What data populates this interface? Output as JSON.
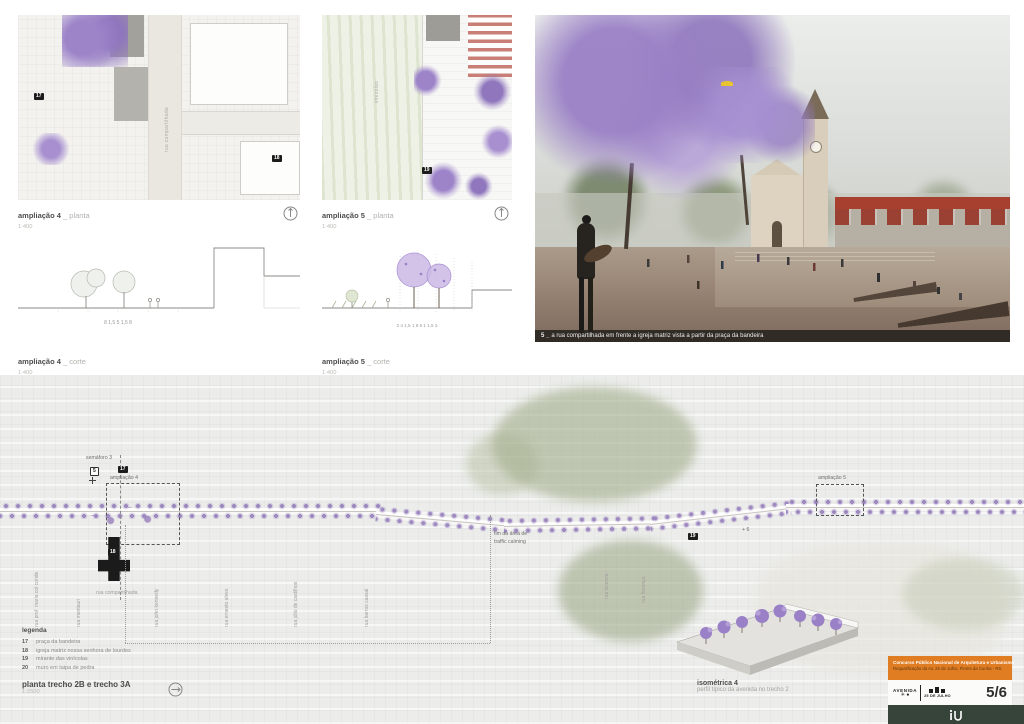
{
  "colors": {
    "jacaranda": "#9a80c6",
    "accent_orange": "#e07c22",
    "footer_green": "#36443a",
    "crosswalk_red": "#b03c2e"
  },
  "panels": {
    "amp4_planta": {
      "title": "ampliação 4",
      "suffix": " _ planta",
      "scale": "1:400"
    },
    "amp4_corte": {
      "title": "ampliação 4",
      "suffix": " _ corte",
      "scale": "1:400",
      "dims": "8     1,5     5     1,5     8"
    },
    "amp5_planta": {
      "title": "ampliação 5",
      "suffix": " _ planta",
      "scale": "1:400"
    },
    "amp5_corte": {
      "title": "ampliação 5",
      "suffix": " _ corte",
      "scale": "1:400",
      "dims": "2    4    1,5  1    6    6    1  1,5    3"
    },
    "amp4_plan_street": "rua compartilhada",
    "amp5_plan_area": "vinícolas"
  },
  "markers": {
    "m5": "5",
    "m17": "17",
    "m18": "18",
    "m19": "19"
  },
  "render": {
    "caption_num": "5 _",
    "caption": "a rua compartilhada em frente a igreja matriz vista a partir da praça da bandeira"
  },
  "site_plan": {
    "semaforo": "semáforo 3",
    "amp4_label": "ampliação 4",
    "amp5_label": "ampliação 5",
    "traffic_line1": "fim da área de",
    "traffic_line2": "traffic calming",
    "shared_street": "rua compartilhada",
    "plus6": "+ 6",
    "streets": [
      "rua prof. maria col conde",
      "rua montauri",
      "rua john kennedy",
      "rua ernesto alves",
      "rua júlio de castilhos",
      "rua barros cassal",
      "rua vicenza",
      "rua florença"
    ],
    "legend": {
      "title": "legenda",
      "items": [
        {
          "num": "17",
          "label": "praça da bandeira"
        },
        {
          "num": "18",
          "label": "igreja matriz nossa senhora de lourdes"
        },
        {
          "num": "19",
          "label": "mirante das vinícolas"
        },
        {
          "num": "20",
          "label": "muro em taipa de pedra"
        }
      ]
    },
    "title": "planta trecho 2B e trecho 3A",
    "scale": "1:2500",
    "isometric_title": "isométrica 4",
    "isometric_subtitle": "perfil típico da avenida no trecho 2"
  },
  "titleblock": {
    "line1": "Concurso Público Nacional de Arquitetura e Urbanismo",
    "line2": "Requalificação da Av. 25 de Julho, Flores da Cunha - RS.",
    "brand_top": "AVENIDA",
    "brand_symbols": "✳ ●",
    "brand_bottom": "25 DE JULHO",
    "sheet": "5/6"
  }
}
